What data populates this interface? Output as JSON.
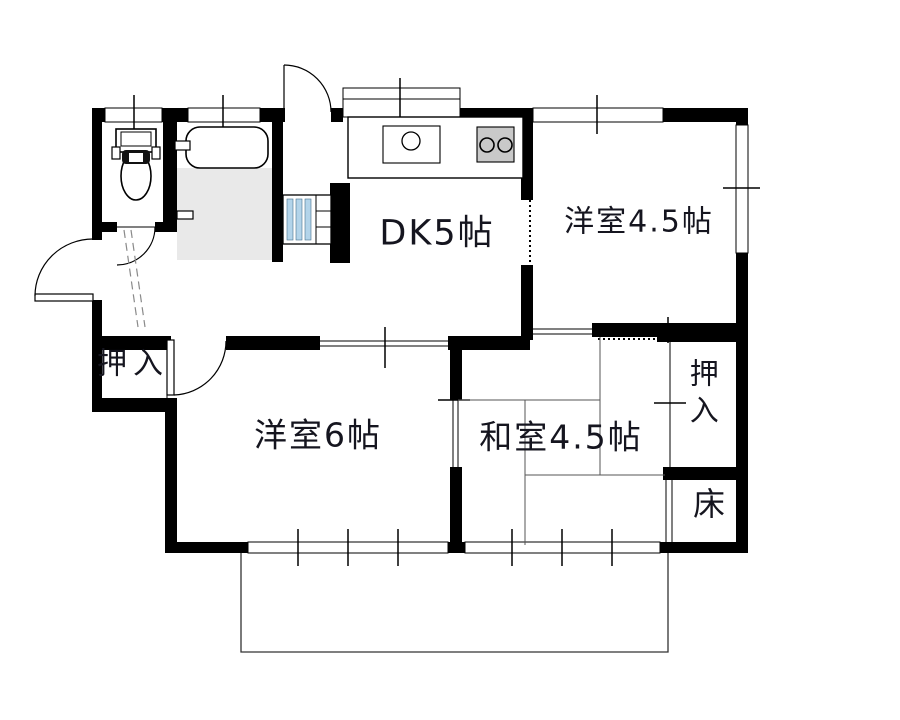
{
  "meta": {
    "type": "floor-plan",
    "language": "ja"
  },
  "rooms": {
    "dk": {
      "label": "DK5帖",
      "size_jo": 5
    },
    "western_room_small": {
      "label": "洋室4.5帖",
      "size_jo": 4.5
    },
    "western_room_large": {
      "label": "洋室6帖",
      "size_jo": 6
    },
    "japanese_room": {
      "label": "和室4.5帖",
      "size_jo": 4.5
    },
    "closet_hall": {
      "label": "押入"
    },
    "closet_japanese": {
      "label": "押入"
    },
    "tokonoma": {
      "label": "床"
    }
  },
  "fixtures": [
    "toilet-icon",
    "bathtub-icon",
    "bath-floor",
    "washbasin-icon",
    "kitchen-counter",
    "kitchen-sink-icon",
    "stove-icon",
    "balcony"
  ],
  "colors": {
    "wall": "#000000",
    "bath_floor": "#e9e9e9",
    "stove": "#c9c9c9",
    "washbasin_stripe": "#b3d4ea",
    "text": "#15151f",
    "background": "#ffffff"
  }
}
